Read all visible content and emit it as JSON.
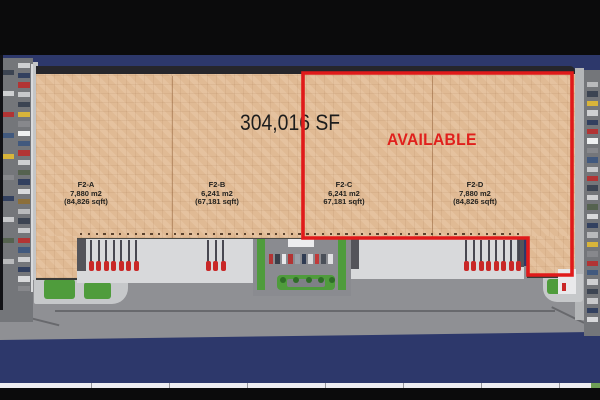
{
  "page": {
    "frame_color": "#0b0b0c",
    "canvas_color": "#2d386b"
  },
  "title": {
    "text": "304,016 SF",
    "color": "#1c1c1c"
  },
  "availability": {
    "label": "AVAILABLE",
    "color": "#e0201c"
  },
  "units": [
    {
      "id": "F2-A",
      "area_m2": "7,880 m2",
      "area_sqft": "(84,826 sqft)"
    },
    {
      "id": "F2-B",
      "area_m2": "6,241 m2",
      "area_sqft": "(67,181 sqft)"
    },
    {
      "id": "F2-C",
      "area_m2": "6,241 m2",
      "area_sqft": "67,181 sqft)"
    },
    {
      "id": "F2-D",
      "area_m2": "7,880 m2",
      "area_sqft": "(84,826 sqft)"
    }
  ],
  "site": {
    "roof_color": "#e0ba94",
    "outline_color": "#e01a1a",
    "apron_color": "#d8d9db",
    "pavement_color": "#8f9094",
    "road_color": "#74767a",
    "landscape_color": "#4f9c3c",
    "truck_cab_color": "#c92727",
    "truck_trailer_color": "#474750",
    "dock_doors": {
      "count": 57,
      "color": "#5c432e"
    },
    "left_cars": [
      "#cfd0d2",
      "#32405f",
      "#b23434",
      "#c8c9cb",
      "#3c4452",
      "#d8b43a",
      "#87888c",
      "#eef0f1",
      "#41597e",
      "#b23434",
      "#cfd0d2",
      "#55624f",
      "#32405f",
      "#d8d9db",
      "#8c6f3a",
      "#b9babc",
      "#3c4452",
      "#c8c9cb",
      "#b23434",
      "#41597e",
      "#cfd0d2",
      "#32405f",
      "#d8d9db",
      "#87888c"
    ],
    "left_cars_inner": [
      "#3c4452",
      "#cfd0d2",
      "#b23434",
      "#41597e",
      "#d8b43a",
      "#87888c",
      "#32405f",
      "#c8c9cb",
      "#55624f",
      "#b9babc"
    ],
    "right_cars": [
      "#b9babc",
      "#3c4452",
      "#d8b43a",
      "#cfd0d2",
      "#32405f",
      "#b23434",
      "#eef0f1",
      "#87888c",
      "#41597e",
      "#c8c9cb",
      "#b23434",
      "#3c4452",
      "#cfd0d2",
      "#55624f",
      "#d8d9db",
      "#32405f",
      "#b9babc",
      "#d8b43a",
      "#87888c",
      "#b23434",
      "#41597e",
      "#cfd0d2",
      "#3c4452",
      "#c8c9cb",
      "#32405f",
      "#d8d9db"
    ],
    "entrance_cars": [
      "#b23434",
      "#3a3f4a",
      "#e8e8ea",
      "#b23434",
      "#9aa0a8",
      "#2f3b52",
      "#d8d8da",
      "#c03a3a",
      "#4a4f58",
      "#e0e0e2"
    ],
    "truck_groups": [
      {
        "x": 90,
        "count": 7
      },
      {
        "x": 207,
        "count": 3
      },
      {
        "x": 465,
        "count": 8
      }
    ],
    "island_bushes": [
      280,
      293,
      306,
      318,
      329
    ],
    "ruler_ticks": [
      91,
      169,
      247,
      325,
      403,
      481,
      559
    ]
  }
}
